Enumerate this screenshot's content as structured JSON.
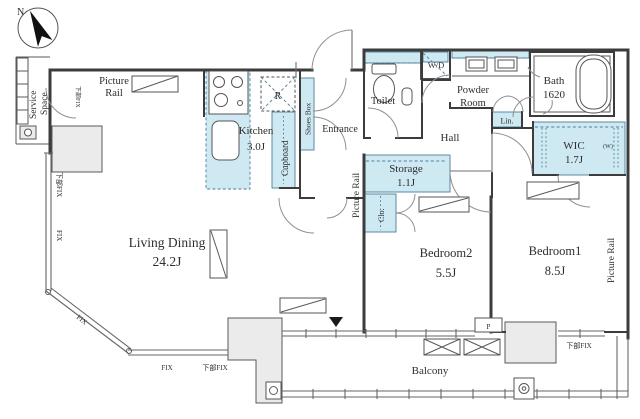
{
  "compass": {
    "north": "N"
  },
  "rooms": {
    "living_dining": {
      "name": "Living Dining",
      "size": "24.2J"
    },
    "kitchen": {
      "name": "Kitchen",
      "size": "3.0J"
    },
    "bedroom1": {
      "name": "Bedroom1",
      "size": "8.5J"
    },
    "bedroom2": {
      "name": "Bedroom2",
      "size": "5.5J"
    },
    "storage": {
      "name": "Storage",
      "size": "1.1J"
    },
    "wic": {
      "name": "WIC",
      "size": "1.7J",
      "hanger_note": "(W)"
    },
    "bath": {
      "name": "Bath",
      "size": "1620"
    },
    "toilet": {
      "name": "Toilet"
    },
    "powder_room": {
      "line1": "Powder",
      "line2": "Room"
    },
    "entrance": {
      "name": "Entrance"
    },
    "hall": {
      "name": "Hall"
    },
    "balcony": {
      "name": "Balcony"
    },
    "service_space": {
      "line1": "Service",
      "line2": "Space"
    }
  },
  "fixtures": {
    "cupboard": "Cupboard",
    "shoes_box": "Shoes Box",
    "washer_dryer": "W/D",
    "linen": "Lin.",
    "closet": "Clo.",
    "refrigerator": "R",
    "pipe_space": "P"
  },
  "picture_rail": {
    "top_left_line1": "Picture",
    "top_left_line2": "Rail",
    "center": "Picture Rail",
    "right": "Picture Rail"
  },
  "window_labels": {
    "left_lower_fix": "下部FIX",
    "left_fix": "FIX",
    "diagonal_fix": "FIX",
    "bottom_fix": "FIX",
    "bottom_lower_fix": "下部FIX",
    "bedroom1_lower_fix": "下部FIX",
    "service_door_lower_fix": "下部FIX"
  },
  "colors": {
    "fixture_fill": "#cfe9f3",
    "fixture_stroke": "#4a7f99",
    "wall": "#3c3c3c",
    "column_fill": "#ebebeb",
    "background": "#ffffff"
  }
}
